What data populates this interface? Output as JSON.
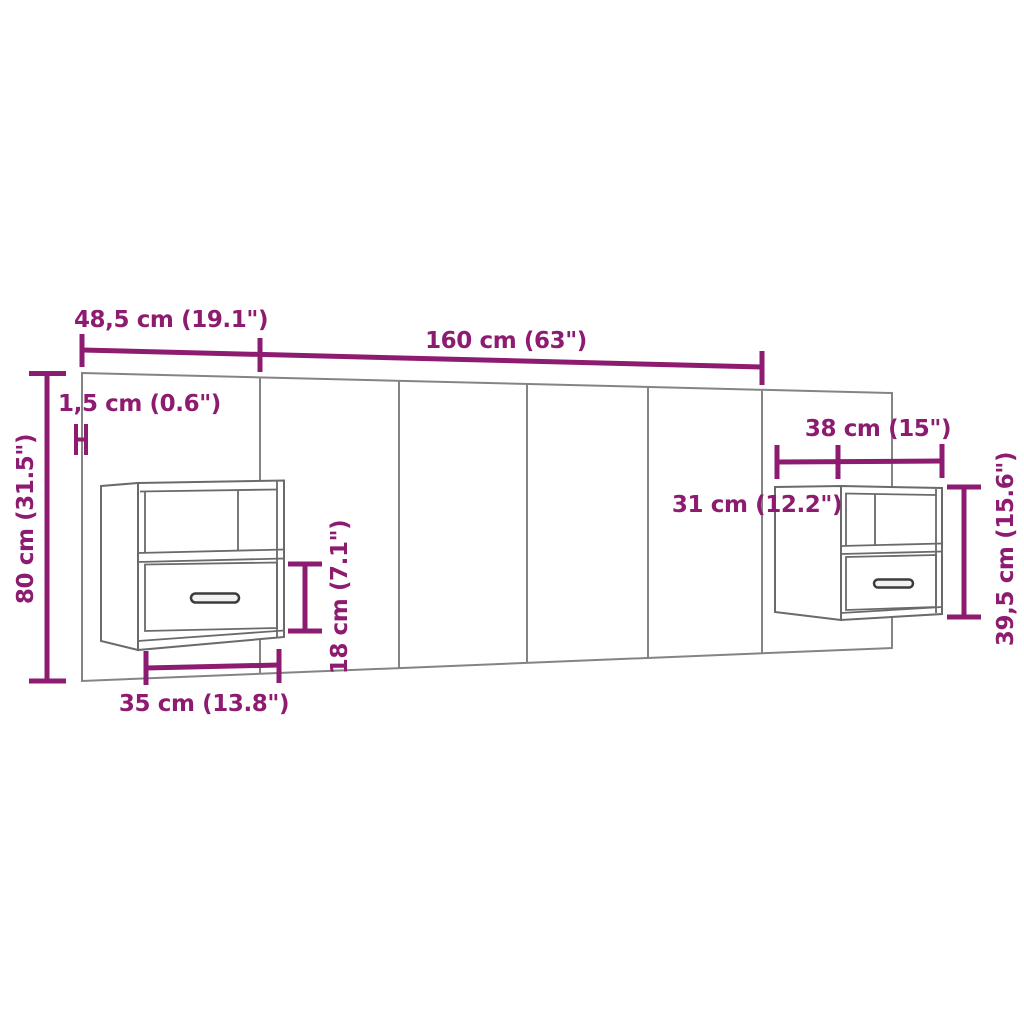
{
  "diagram": {
    "kind": "furniture-dimension-diagram",
    "subject": "wall headboard with two floating bedside cabinets"
  },
  "colors": {
    "dimension_accent": "#8D1B70",
    "headboard_outline": "#848484",
    "cabinet_outline": "#6A6A6A"
  },
  "dimensions": {
    "top_left_section_width": "48,5 cm (19.1\")",
    "top_center_width": "160 cm (63\")",
    "panel_thickness": "1,5 cm (0.6\")",
    "headboard_height": "80 cm (31.5\")",
    "left_cabinet_width": "35 cm (13.8\")",
    "left_cabinet_drawer_height": "18 cm (7.1\")",
    "right_cabinet_width": "38 cm (15\")",
    "right_cabinet_depth": "31 cm (12.2\")",
    "right_cabinet_height": "39,5 cm (15.6\")"
  }
}
